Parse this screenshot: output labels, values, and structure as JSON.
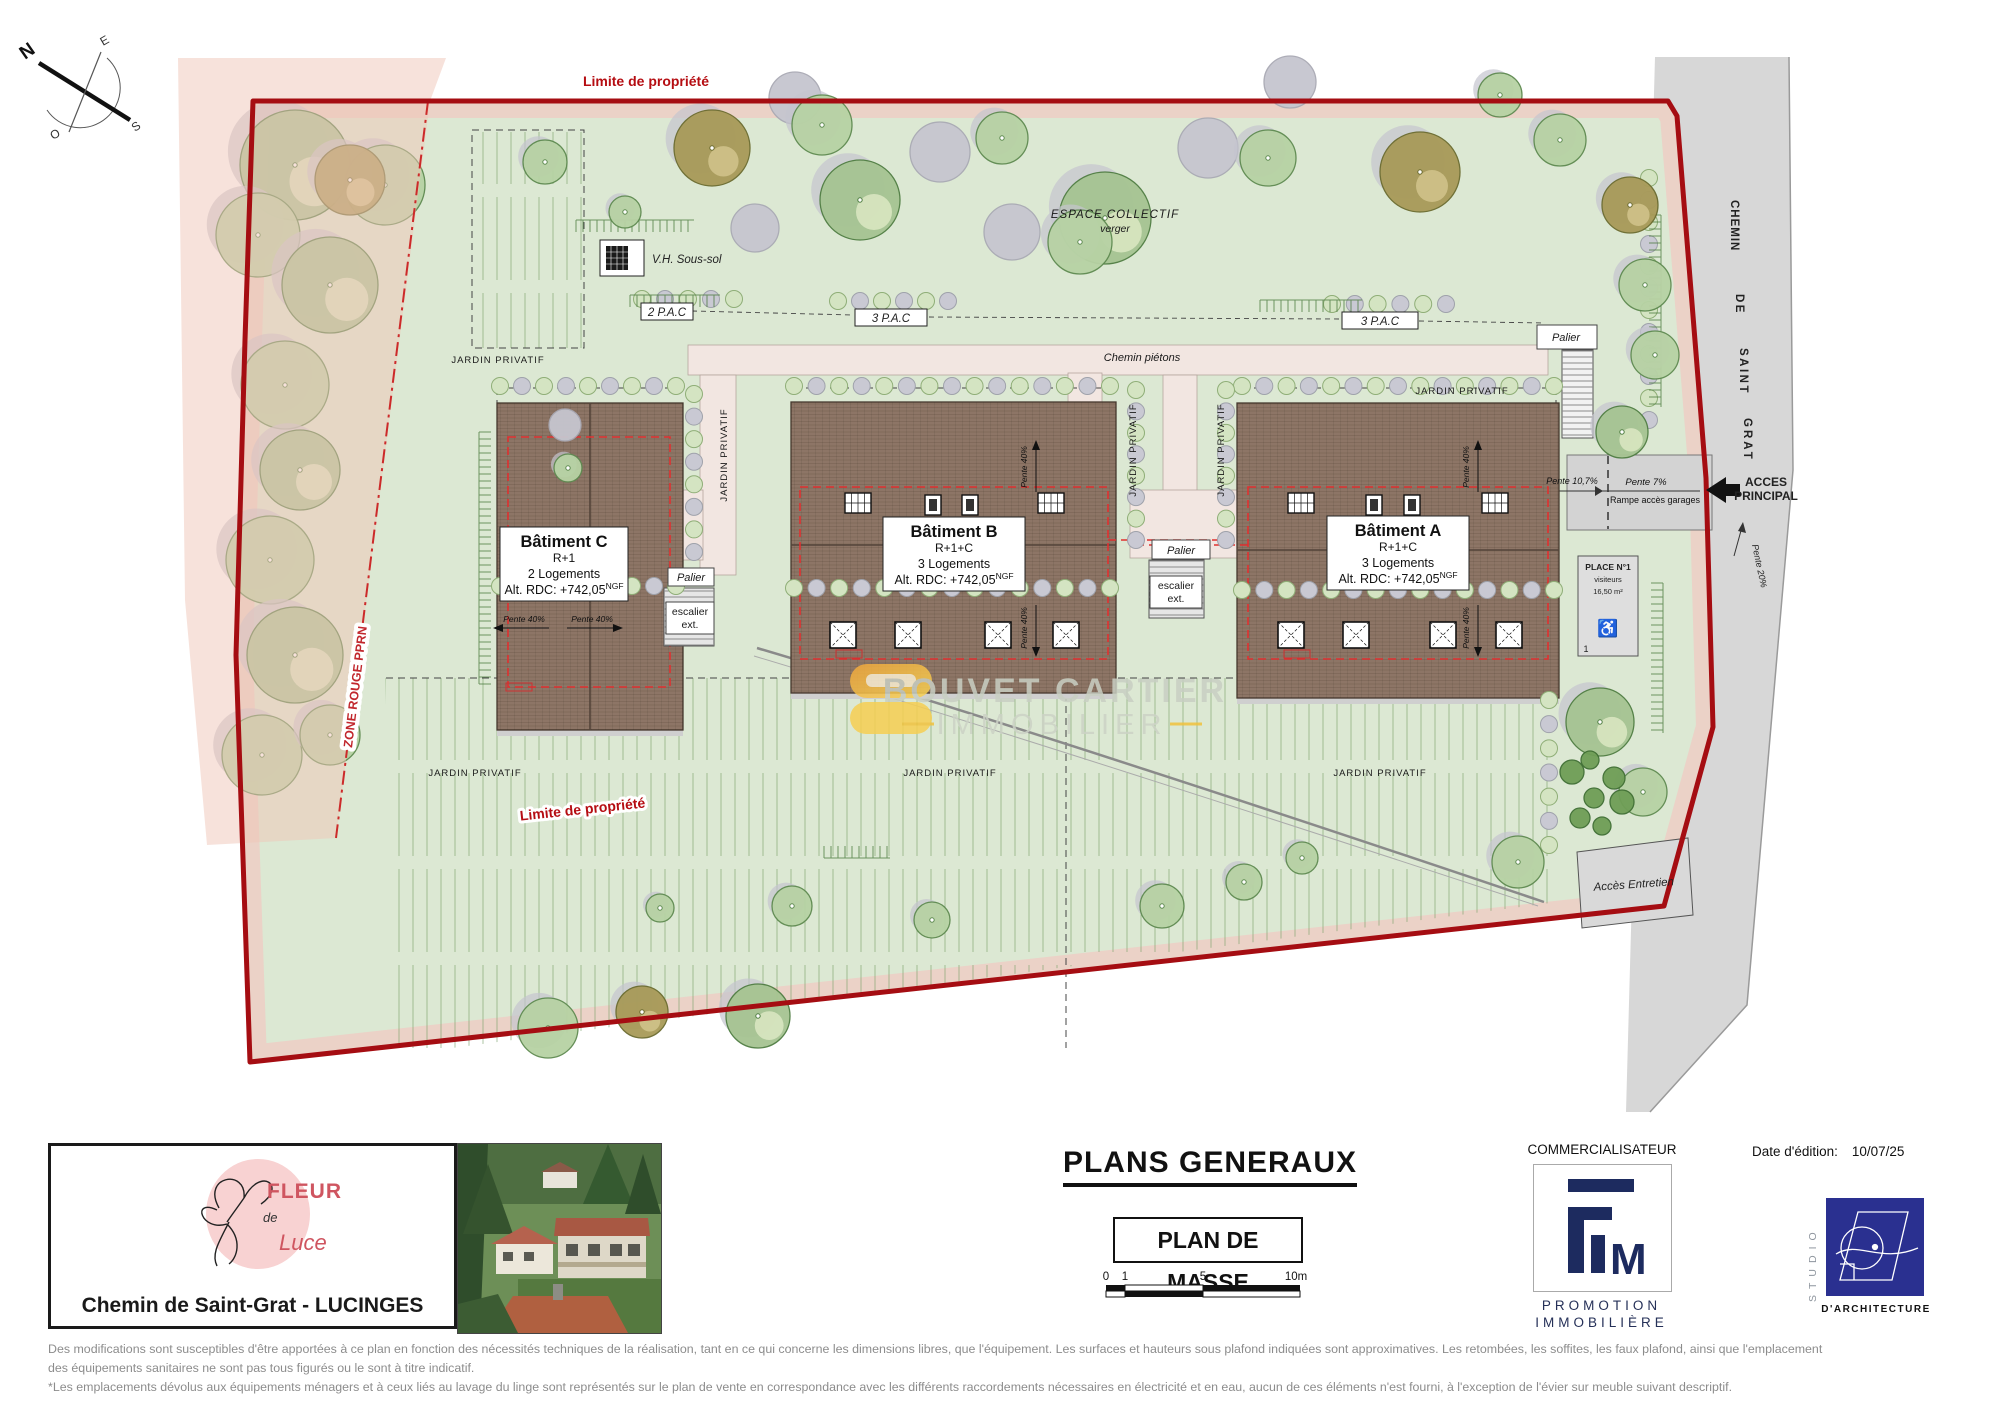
{
  "compass": {
    "n": "N",
    "e": "E",
    "s": "S",
    "o": "O"
  },
  "plan": {
    "limite": "Limite de propriété",
    "zone_rouge": "ZONE ROUGE PPRN",
    "espace_collectif": "ESPACE COLLECTIF",
    "verger": "verger",
    "vh_soussol": "V.H. Sous-sol",
    "pac2": "2 P.A.C",
    "pac3": "3 P.A.C",
    "chemin_pietons": "Chemin piétons",
    "jardin_privatif": "JARDIN PRIVATIF",
    "palier": "Palier",
    "escalier_l1": "escalier",
    "escalier_l2": "ext.",
    "pente40": "Pente 40%",
    "pente107": "Pente 10,7%",
    "pente7": "Pente 7%",
    "pente20": "Pente 20%",
    "rampe": "Rampe accès garages",
    "acces_l1": "ACCES",
    "acces_l2": "PRINCIPAL",
    "acces_entretien": "Accès Entretien",
    "place_title": "PLACE N°1",
    "place_sub": "visiteurs",
    "place_area": "16,50 m²",
    "place_num": "1",
    "place_icon": "♿",
    "road_l1": "CHEMIN",
    "road_l2": "DE",
    "road_l3": "SAINT",
    "road_l4": "GRAT",
    "buildings": {
      "a": {
        "name": "Bâtiment A",
        "floors": "R+1+C",
        "units": "3 Logements",
        "alt": "Alt. RDC: +742,05",
        "alt_sup": "NGF"
      },
      "b": {
        "name": "Bâtiment B",
        "floors": "R+1+C",
        "units": "3 Logements",
        "alt": "Alt. RDC: +742,05",
        "alt_sup": "NGF"
      },
      "c": {
        "name": "Bâtiment C",
        "floors": "R+1",
        "units": "2 Logements",
        "alt": "Alt. RDC: +742,05",
        "alt_sup": "NGF"
      }
    },
    "watermark_l1": "BOUVET CARTIER",
    "watermark_l2": "IMMOBILIER"
  },
  "footer": {
    "logo_top": "FLEUR",
    "logo_mid": "de",
    "logo_bot": "Luce",
    "address": "Chemin de Saint-Grat - LUCINGES",
    "title": "PLANS GENERAUX",
    "subtitle": "PLAN DE MASSE",
    "scale": {
      "t0": "0",
      "t1": "1",
      "t5": "5",
      "t10": "10m"
    },
    "commercialisateur": "COMMERCIALISATEUR",
    "fim_m": "M",
    "promo_l1": "PROMOTION",
    "promo_l2": "IMMOBILIÈRE",
    "date_label": "Date d'édition:",
    "date_value": "10/07/25",
    "studio_vertical": "STUDIO",
    "studio_bottom": "D'ARCHITECTURE"
  },
  "disclaimer": {
    "line1": "Des modifications sont susceptibles d'être apportées à ce plan en fonction des nécessités techniques de la réalisation, tant en ce qui concerne les dimensions libres, que l'équipement. Les surfaces et hauteurs sous plafond indiquées sont approximatives. Les retombées, les soffites, les faux plafond, ainsi que l'emplacement",
    "line2": "des équipements sanitaires ne sont pas tous figurés ou le sont à titre indicatif.",
    "line3": "*Les emplacements dévolus aux équipements ménagers et à ceux liés au lavage du linge sont représentés sur le plan de vente en correspondance avec les différents raccordements nécessaires en électricité et en eau, aucun de ces éléments n'est fourni, à l'exception de l'évier sur meuble suivant descriptif."
  }
}
